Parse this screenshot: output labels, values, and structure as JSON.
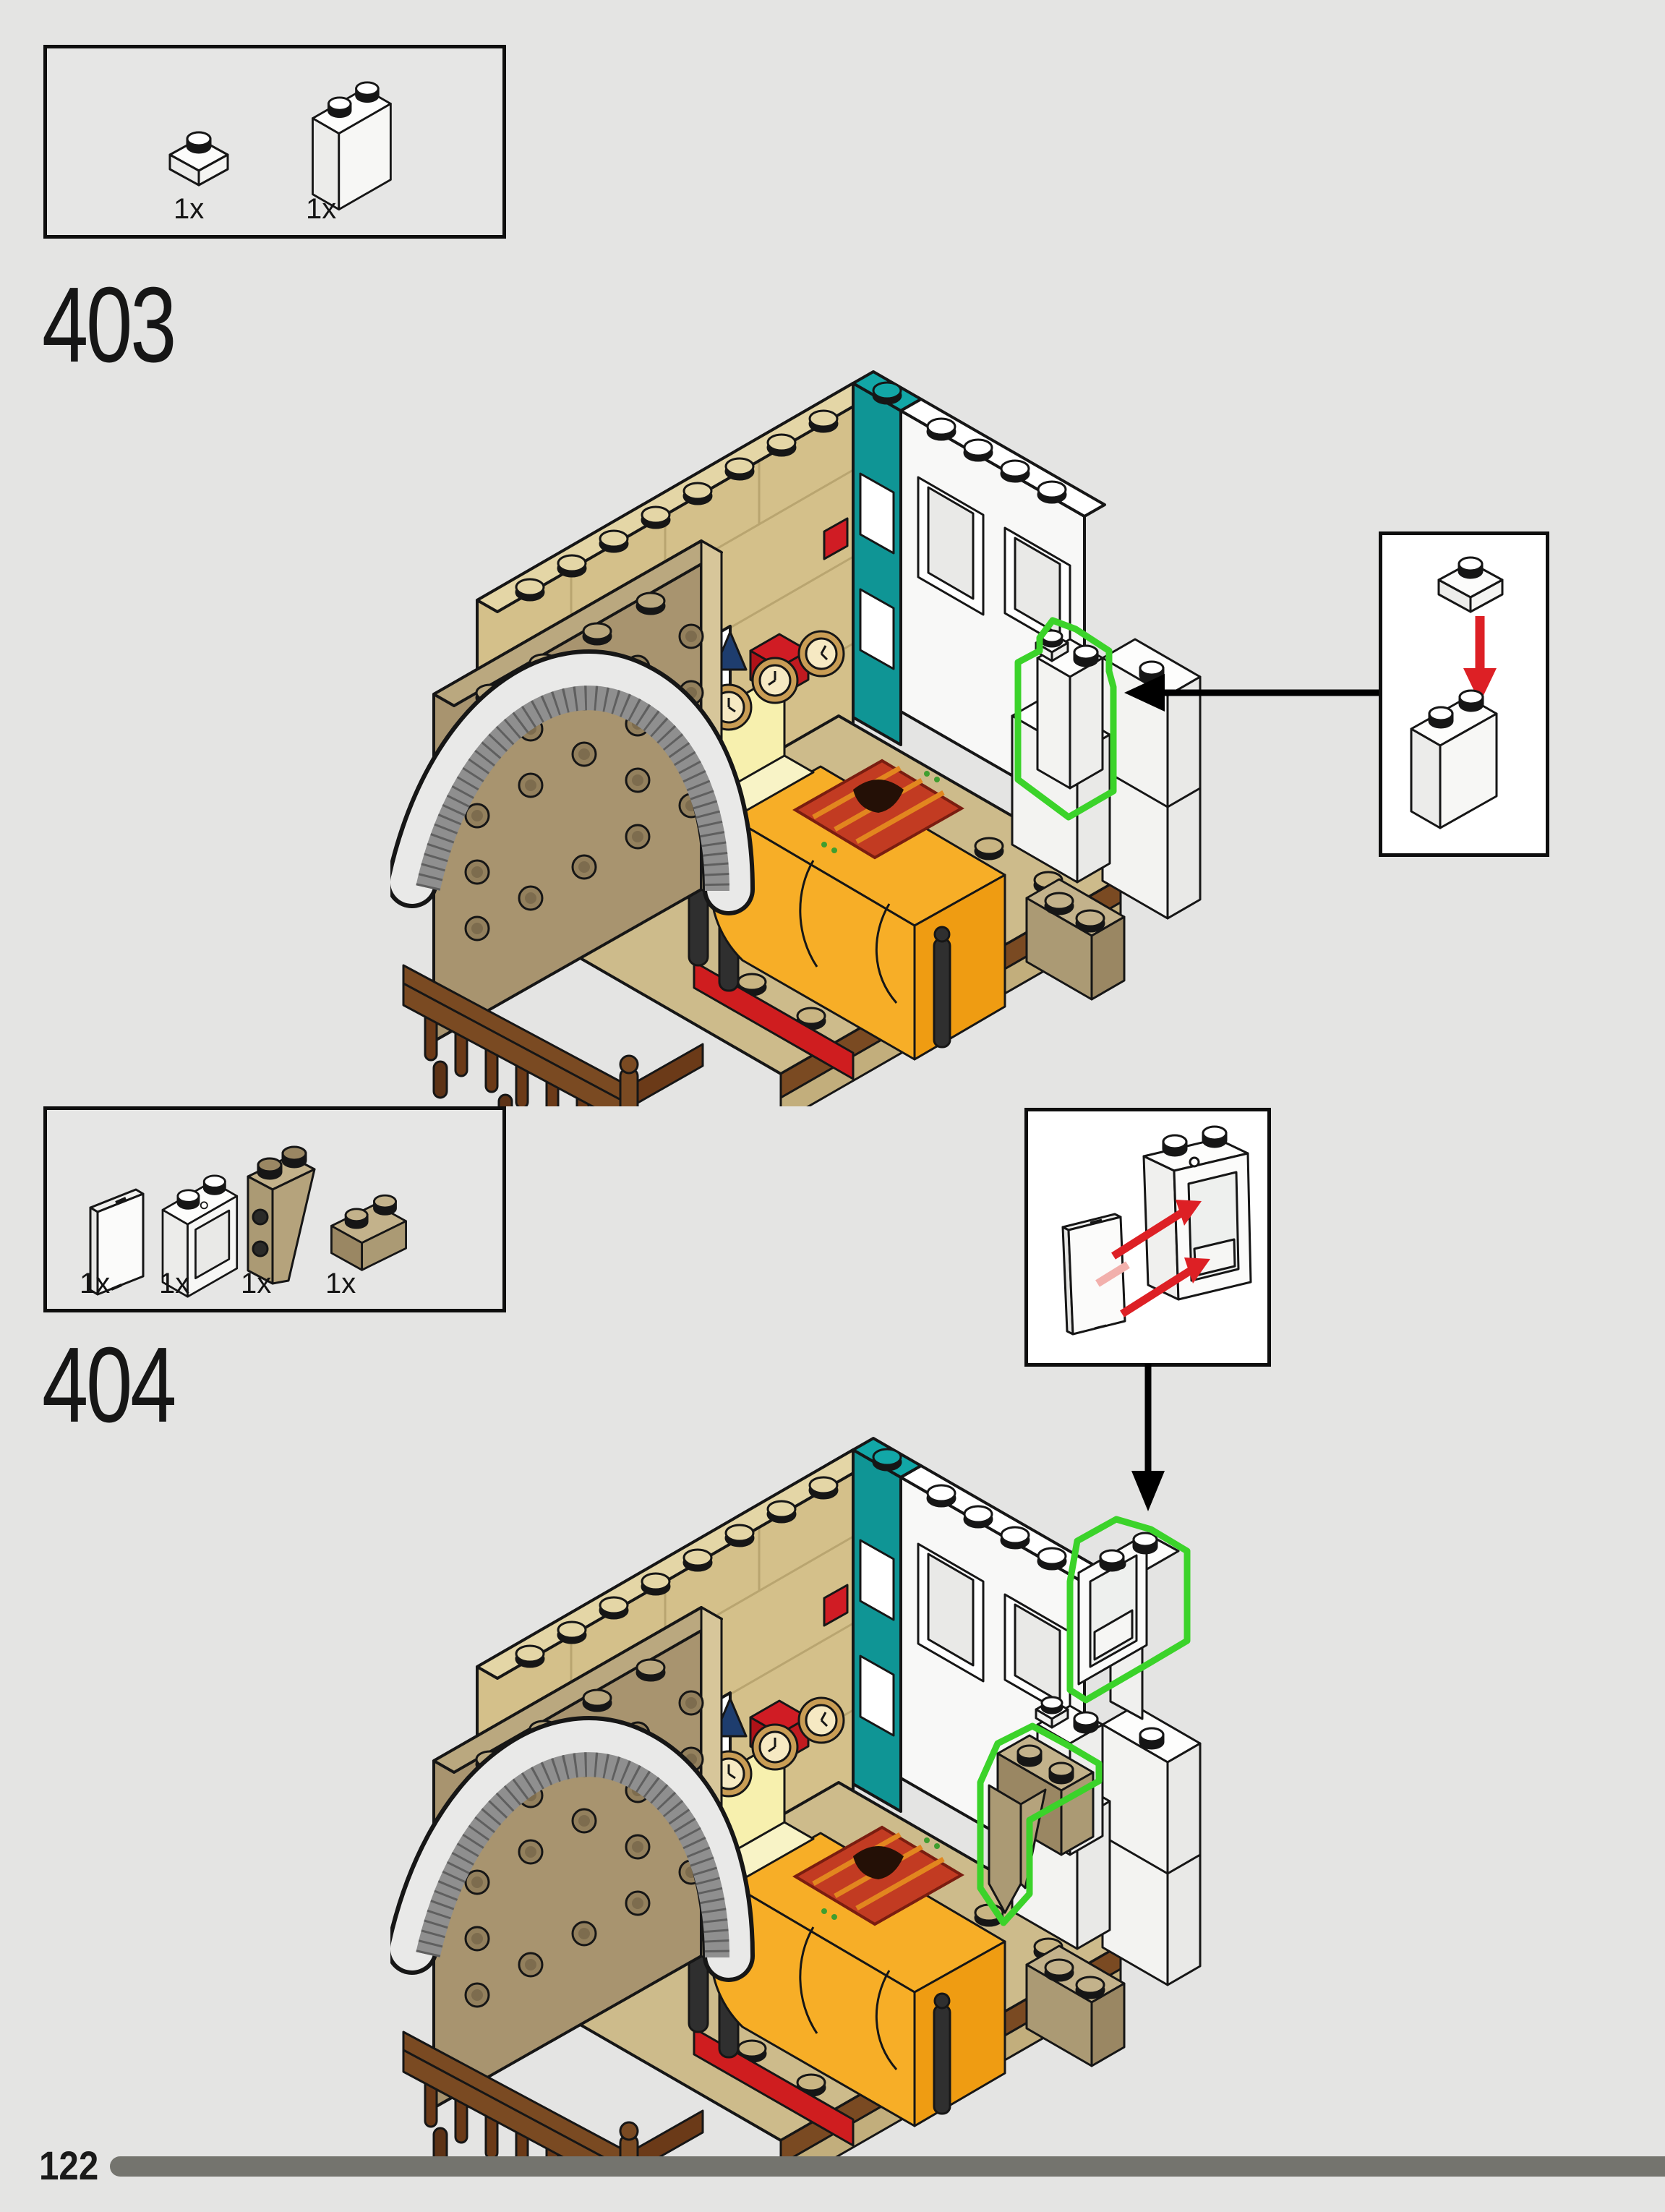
{
  "page": {
    "number": "122"
  },
  "colors": {
    "background": "#e4e4e3",
    "highlight_green": "#3bd32a",
    "arrow_red": "#dd2025",
    "arrow_black": "#000000",
    "tan_wall": "#d4c08a",
    "dark_tan_wall": "#a8946f",
    "teal": "#0f9595",
    "balcony_brown": "#7a4a22",
    "bed_orange": "#f7ae27",
    "bed_base_red": "#cf1d1f",
    "progress_bar": "#74746e"
  },
  "steps": [
    {
      "number": "403",
      "parts": [
        {
          "name": "plate-1x1-white",
          "count": "1x"
        },
        {
          "name": "brick-1x2x2-white",
          "count": "1x"
        }
      ],
      "callout": {
        "shows": "place white 1x1 plate onto white 1x2x2 brick",
        "arrow_color": "red"
      }
    },
    {
      "number": "404",
      "parts": [
        {
          "name": "panel-1x2x2-white",
          "count": "1x"
        },
        {
          "name": "window-frame-1x2x2-white",
          "count": "1x"
        },
        {
          "name": "slope-inverted-2x1x3-dark-tan",
          "count": "1x"
        },
        {
          "name": "brick-1x2-dark-tan",
          "count": "1x"
        }
      ],
      "callout": {
        "shows": "insert white panel into window frame",
        "arrow_color": "red"
      }
    }
  ],
  "footer": {
    "page_number": "122"
  }
}
